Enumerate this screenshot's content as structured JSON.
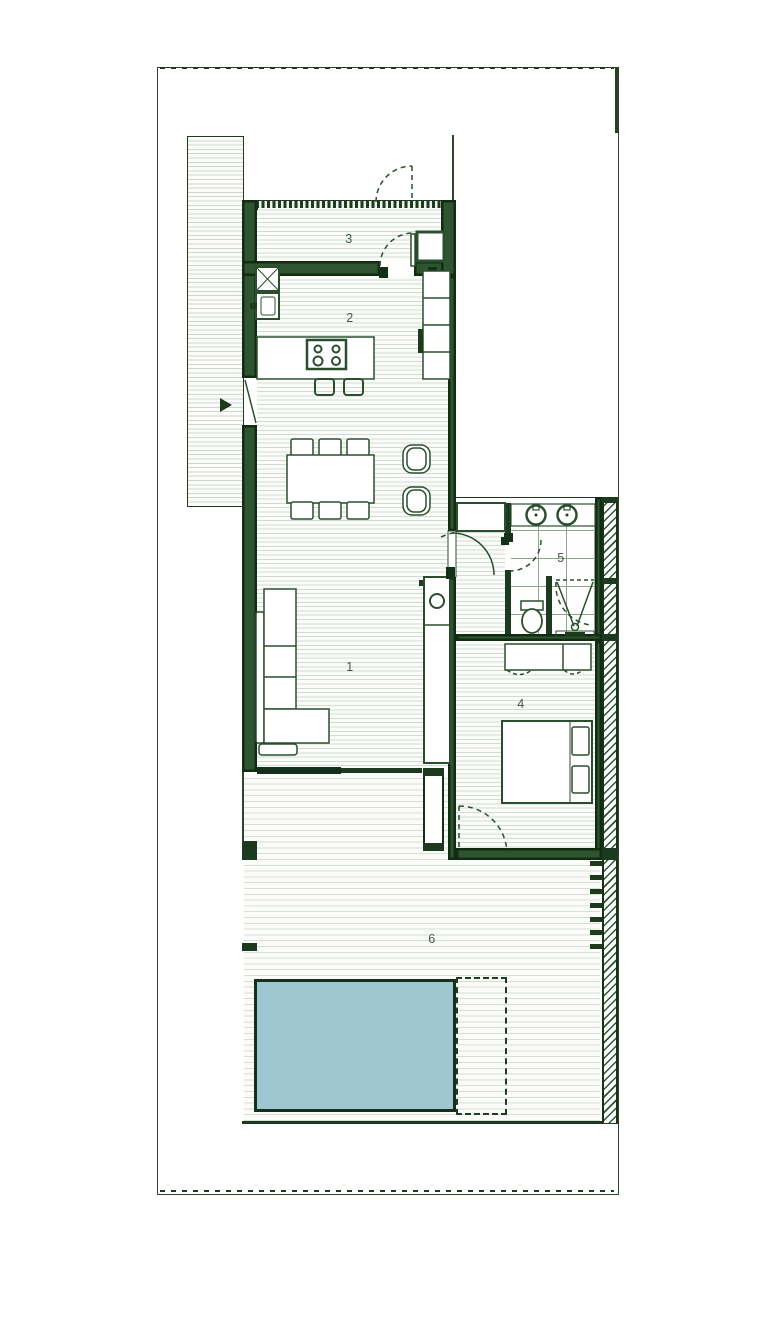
{
  "plan": {
    "room_labels": [
      {
        "id": "living-room",
        "label": "1"
      },
      {
        "id": "kitchen",
        "label": "2"
      },
      {
        "id": "entry-storage",
        "label": "3"
      },
      {
        "id": "bedroom",
        "label": "4"
      },
      {
        "id": "bathroom",
        "label": "5"
      },
      {
        "id": "terrace",
        "label": "6"
      }
    ],
    "colors": {
      "wall_dark": "#122c12",
      "wall_core": "#2e5530",
      "furniture_outline": "#2b4f2e",
      "floor_line": "#d2dbd2",
      "tile_line": "#8fa58f",
      "pool_fill": "#9fc7d1",
      "pool_border": "#14301a",
      "boundary": "#2c452c",
      "label_text": "#44564c"
    }
  }
}
